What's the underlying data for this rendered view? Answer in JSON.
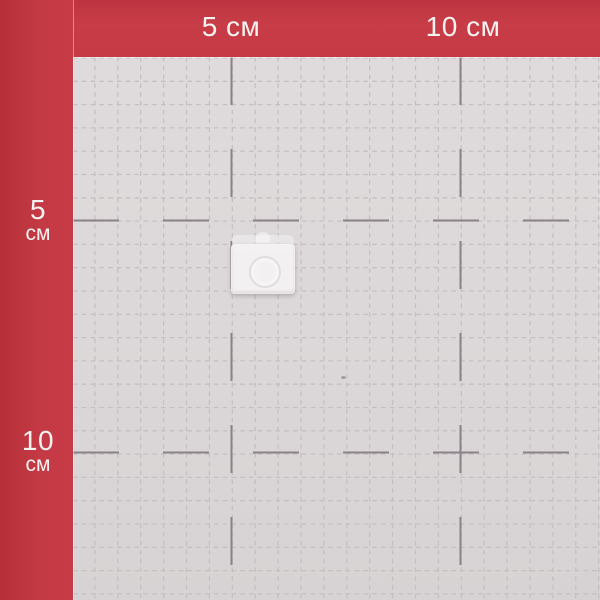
{
  "ruler": {
    "unit": "см",
    "top_labels": [
      {
        "label": "5 см",
        "cm": 5
      },
      {
        "label": "10 см",
        "cm": 10
      }
    ],
    "left_labels": [
      {
        "value": "5",
        "unit": "см",
        "cm": 5
      },
      {
        "value": "10",
        "unit": "см",
        "cm": 10
      }
    ]
  },
  "colors": {
    "frame_red": "#c53a44",
    "frame_red_dark": "#b52f39",
    "grid_background": "#dcd8d9",
    "fine_line": "#c6bfc2",
    "major_line": "#8a8288",
    "label_text": "#f5f2f2"
  }
}
